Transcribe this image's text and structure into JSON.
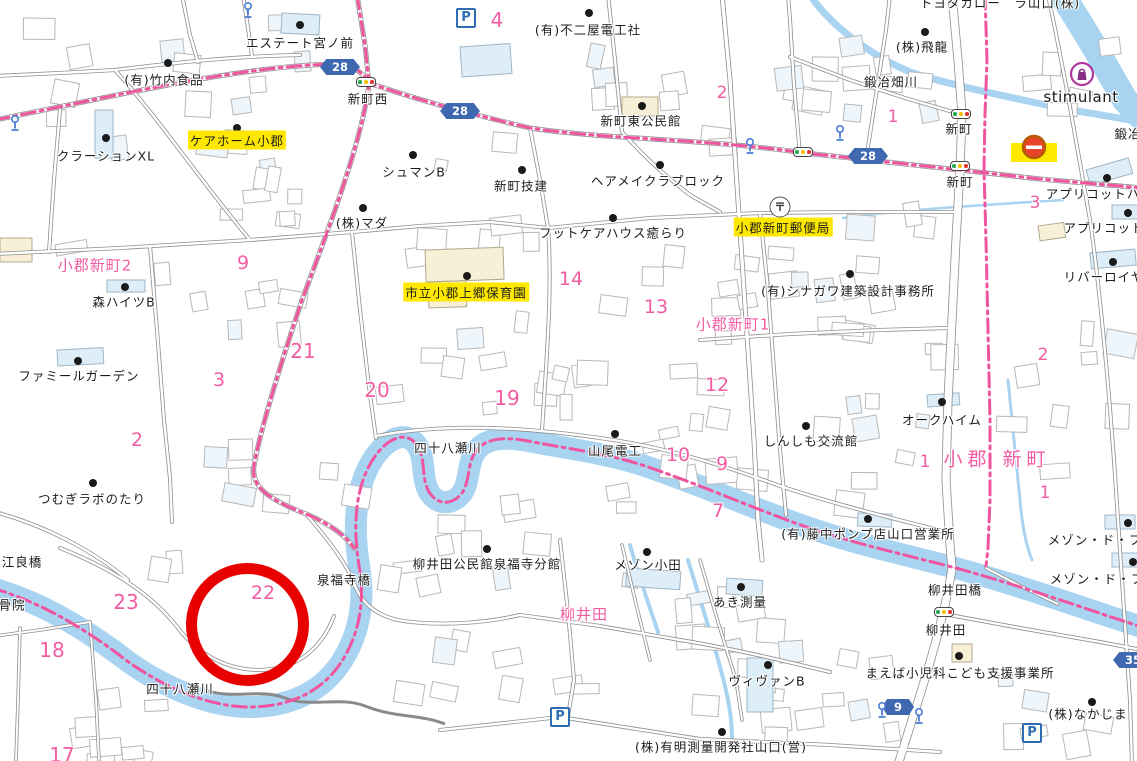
{
  "map": {
    "colors": {
      "boundary": "#f0549e",
      "river": "#a8d4f2",
      "stream": "#a8d4f2",
      "road_casing": "#8f8f8f",
      "road_fill": "#ffffff",
      "building_outline": "#b8b8b8",
      "apartment_fill": "#ddeef8",
      "public_fill": "#f8f0d6",
      "highlight": "#ffe800",
      "number": "#f25ca2",
      "shield": "#3e68b0",
      "annotation": "#e80000",
      "traffic_green": "#1faa50",
      "traffic_yellow": "#f6c000",
      "traffic_red": "#e53333",
      "lamp_blue": "#4a7fd4",
      "parking_blue": "#2e6db4"
    },
    "area_labels": [
      {
        "t": "小郡新町2",
        "x": 95,
        "y": 265,
        "style": "pink"
      },
      {
        "t": "小郡新町1",
        "x": 733,
        "y": 324,
        "style": "pink"
      },
      {
        "t": "小郡 新町",
        "x": 997,
        "y": 458,
        "style": "pinkbig"
      },
      {
        "t": "柳井田",
        "x": 584,
        "y": 614,
        "style": "pink"
      }
    ],
    "poi_labels": [
      {
        "t": "エステート宮ノ前",
        "x": 300,
        "y": 42,
        "d": [
          300,
          25
        ]
      },
      {
        "t": "(有)竹内食品",
        "x": 164,
        "y": 79,
        "d": [
          168,
          63
        ]
      },
      {
        "t": "クラーションXL",
        "x": 106,
        "y": 155,
        "d": [
          106,
          138
        ]
      },
      {
        "t": "ケアホーム小郡",
        "x": 237,
        "y": 140,
        "d": [
          237,
          128
        ],
        "style": "hl"
      },
      {
        "t": "新町西",
        "x": 368,
        "y": 98
      },
      {
        "t": "シュマンB",
        "x": 414,
        "y": 171,
        "d": [
          413,
          155
        ]
      },
      {
        "t": "(株)マダ",
        "x": 362,
        "y": 222,
        "d": [
          363,
          208
        ]
      },
      {
        "t": "新町技建",
        "x": 521,
        "y": 185,
        "d": [
          522,
          170
        ]
      },
      {
        "t": "ヘアメイクラブロック",
        "x": 658,
        "y": 180,
        "d": [
          660,
          165
        ]
      },
      {
        "t": "フットケアハウス癒らり",
        "x": 613,
        "y": 232,
        "d": [
          613,
          218
        ]
      },
      {
        "t": "(有)不二屋電工社",
        "x": 588,
        "y": 29,
        "d": [
          589,
          13
        ]
      },
      {
        "t": "新町東公民館",
        "x": 641,
        "y": 120,
        "d": [
          642,
          106
        ]
      },
      {
        "t": "(株)飛龍",
        "x": 922,
        "y": 46,
        "d": [
          925,
          32
        ]
      },
      {
        "t": "鍛冶畑川",
        "x": 891,
        "y": 81
      },
      {
        "t": "stimulant",
        "x": 1081,
        "y": 97,
        "style": "latin"
      },
      {
        "t": "新町",
        "x": 959,
        "y": 128
      },
      {
        "t": "新町",
        "x": 960,
        "y": 181
      },
      {
        "t": "トヨタカロー　ラ山口(株)",
        "x": 1000,
        "y": 2
      },
      {
        "t": "アプリコットハ",
        "x": 1093,
        "y": 193,
        "d": [
          1107,
          178
        ]
      },
      {
        "t": "アプリコット",
        "x": 1104,
        "y": 227,
        "d": [
          1128,
          213
        ]
      },
      {
        "t": "リバーロイヤ",
        "x": 1104,
        "y": 276,
        "d": [
          1113,
          262
        ]
      },
      {
        "t": "鍛冶",
        "x": 1128,
        "y": 133
      },
      {
        "t": "市立小郡上郷保育園",
        "x": 466,
        "y": 292,
        "d": [
          467,
          276
        ],
        "style": "hl"
      },
      {
        "t": "小郡新町郵便局",
        "x": 783,
        "y": 227,
        "style": "hl"
      },
      {
        "t": "(有)シナガワ建築設計事務所",
        "x": 848,
        "y": 290,
        "d": [
          850,
          274
        ]
      },
      {
        "t": "森ハイツB",
        "x": 124,
        "y": 301,
        "d": [
          125,
          287
        ]
      },
      {
        "t": "ファミールガーデン",
        "x": 79,
        "y": 375,
        "d": [
          78,
          361
        ]
      },
      {
        "t": "つむぎラボのたり",
        "x": 92,
        "y": 498,
        "d": [
          93,
          483
        ]
      },
      {
        "t": "山尾電工",
        "x": 615,
        "y": 450,
        "d": [
          615,
          434
        ]
      },
      {
        "t": "四十八瀬川",
        "x": 448,
        "y": 447
      },
      {
        "t": "四十八瀬川",
        "x": 180,
        "y": 688
      },
      {
        "t": "しんしも交流館",
        "x": 811,
        "y": 440,
        "d": [
          806,
          426
        ]
      },
      {
        "t": "オークハイム",
        "x": 942,
        "y": 419,
        "d": [
          942,
          402
        ]
      },
      {
        "t": "(有)藤中ポンプ店山口営業所",
        "x": 868,
        "y": 533,
        "d": [
          868,
          519
        ]
      },
      {
        "t": "柳井田公民館泉福寺分館",
        "x": 487,
        "y": 563,
        "d": [
          487,
          549
        ]
      },
      {
        "t": "メゾン小田",
        "x": 648,
        "y": 564,
        "d": [
          647,
          552
        ]
      },
      {
        "t": "あき測量",
        "x": 740,
        "y": 601,
        "d": [
          741,
          587
        ]
      },
      {
        "t": "ヴィヴァンB",
        "x": 767,
        "y": 680,
        "d": [
          768,
          665
        ]
      },
      {
        "t": "(株)有明測量開発社山口(営)",
        "x": 721,
        "y": 746,
        "d": [
          722,
          732
        ]
      },
      {
        "t": "まえば小児科こども支援事業所",
        "x": 960,
        "y": 672,
        "d": [
          959,
          656
        ]
      },
      {
        "t": "(株)なかじま",
        "x": 1088,
        "y": 713,
        "d": [
          1092,
          702
        ]
      },
      {
        "t": "柳井田橋",
        "x": 955,
        "y": 589
      },
      {
        "t": "柳井田",
        "x": 946,
        "y": 629
      },
      {
        "t": "メゾン・ド・フ",
        "x": 1095,
        "y": 539,
        "d": [
          1128,
          523
        ]
      },
      {
        "t": "メゾン・ド・フ",
        "x": 1097,
        "y": 578,
        "d": [
          1133,
          562
        ]
      },
      {
        "t": "江良橋",
        "x": 22,
        "y": 561
      },
      {
        "t": "骨院",
        "x": 12,
        "y": 604
      },
      {
        "t": "泉福寺橋",
        "x": 344,
        "y": 579
      }
    ],
    "block_numbers": [
      {
        "n": "4",
        "x": 497,
        "y": 20,
        "s": 20
      },
      {
        "n": "2",
        "x": 722,
        "y": 93,
        "s": 17
      },
      {
        "n": "1",
        "x": 893,
        "y": 117,
        "s": 17
      },
      {
        "n": "3",
        "x": 1035,
        "y": 203,
        "s": 17
      },
      {
        "n": "2",
        "x": 1043,
        "y": 355,
        "s": 17
      },
      {
        "n": "9",
        "x": 243,
        "y": 263,
        "s": 19
      },
      {
        "n": "21",
        "x": 303,
        "y": 351,
        "s": 20
      },
      {
        "n": "3",
        "x": 219,
        "y": 380,
        "s": 19
      },
      {
        "n": "2",
        "x": 137,
        "y": 440,
        "s": 19
      },
      {
        "n": "20",
        "x": 377,
        "y": 390,
        "s": 20
      },
      {
        "n": "19",
        "x": 507,
        "y": 398,
        "s": 20
      },
      {
        "n": "14",
        "x": 571,
        "y": 279,
        "s": 19
      },
      {
        "n": "13",
        "x": 656,
        "y": 307,
        "s": 19
      },
      {
        "n": "12",
        "x": 717,
        "y": 385,
        "s": 19
      },
      {
        "n": "10",
        "x": 678,
        "y": 455,
        "s": 19
      },
      {
        "n": "9",
        "x": 722,
        "y": 464,
        "s": 19
      },
      {
        "n": "7",
        "x": 718,
        "y": 511,
        "s": 19
      },
      {
        "n": "1",
        "x": 925,
        "y": 462,
        "s": 17
      },
      {
        "n": "1",
        "x": 1045,
        "y": 493,
        "s": 17
      },
      {
        "n": "22",
        "x": 263,
        "y": 593,
        "s": 19
      },
      {
        "n": "23",
        "x": 126,
        "y": 602,
        "s": 20
      },
      {
        "n": "18",
        "x": 52,
        "y": 650,
        "s": 20
      },
      {
        "n": "17",
        "x": 62,
        "y": 755,
        "s": 20
      }
    ],
    "route_shields": [
      {
        "n": "28",
        "x": 340,
        "y": 67
      },
      {
        "n": "28",
        "x": 460,
        "y": 111
      },
      {
        "n": "28",
        "x": 868,
        "y": 156
      },
      {
        "n": "9",
        "x": 898,
        "y": 707
      },
      {
        "n": "35",
        "x": 1133,
        "y": 660
      }
    ],
    "icons": {
      "parking_letter": "P",
      "post_mark": "〒",
      "parking": [
        {
          "x": 466,
          "y": 18
        },
        {
          "x": 560,
          "y": 717
        },
        {
          "x": 1032,
          "y": 733
        }
      ],
      "traffic_lights": [
        {
          "x": 366,
          "y": 82
        },
        {
          "x": 961,
          "y": 114
        },
        {
          "x": 960,
          "y": 166
        },
        {
          "x": 803,
          "y": 152
        },
        {
          "x": 944,
          "y": 612
        }
      ],
      "street_lamps": [
        {
          "x": 248,
          "y": 12
        },
        {
          "x": 15,
          "y": 125
        },
        {
          "x": 840,
          "y": 135
        },
        {
          "x": 882,
          "y": 712
        },
        {
          "x": 919,
          "y": 718
        },
        {
          "x": 750,
          "y": 148
        }
      ],
      "post_office": {
        "x": 780,
        "y": 207
      },
      "shopping_bag": {
        "x": 1082,
        "y": 76
      },
      "gas_station": {
        "x": 1034,
        "y": 151
      }
    },
    "annotation_circle": {
      "cx": 247,
      "cy": 624,
      "r": 46,
      "stroke": 11,
      "color": "#e80000"
    }
  }
}
